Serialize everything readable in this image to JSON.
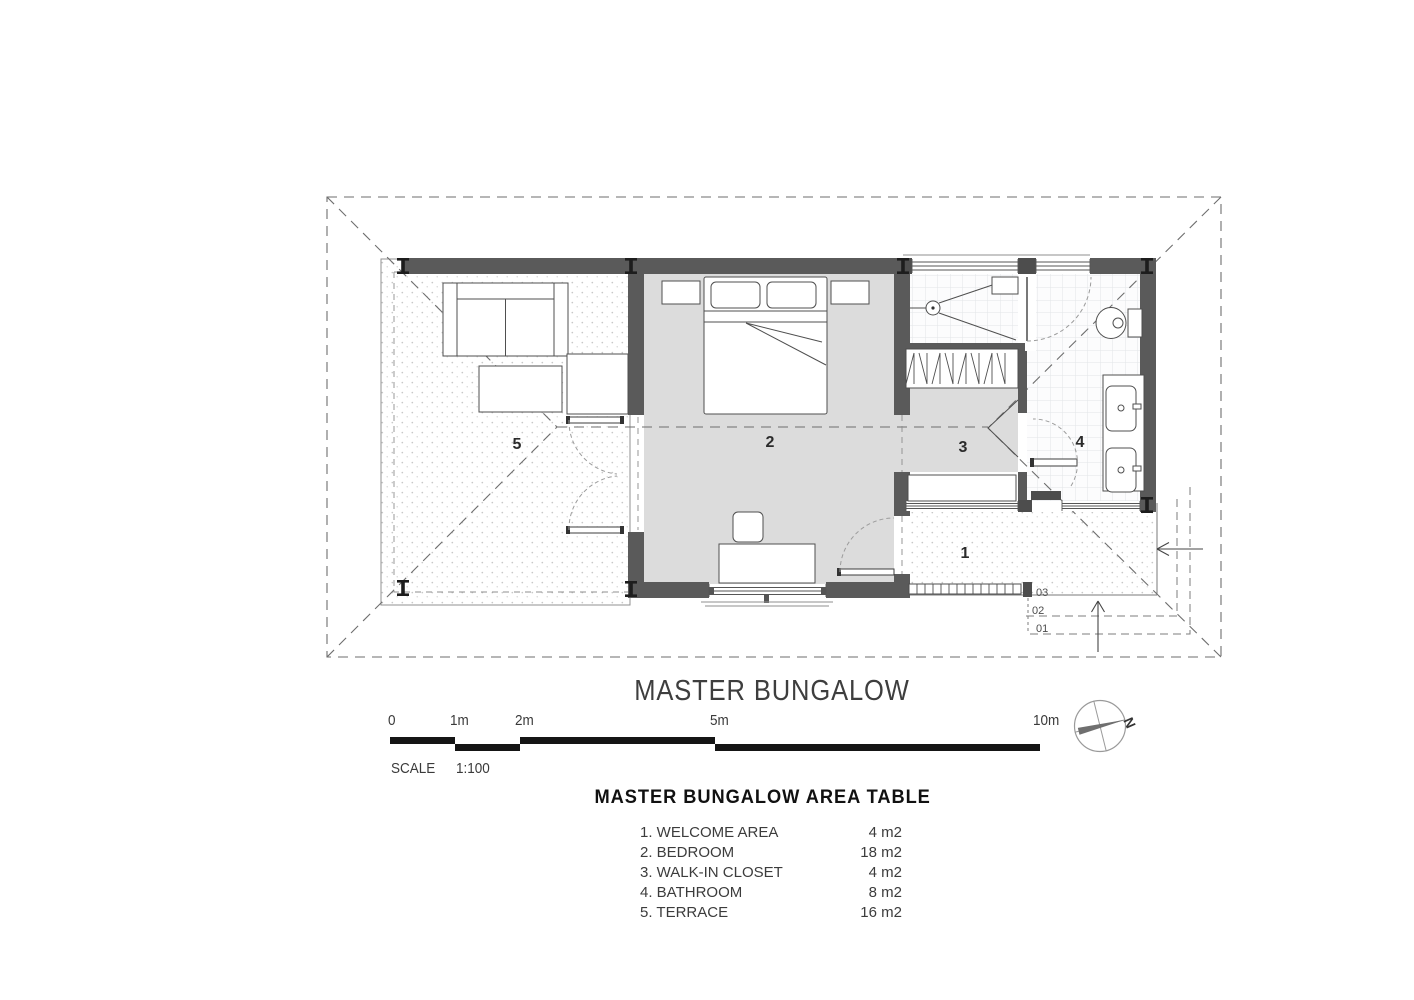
{
  "title": "MASTER BUNGALOW",
  "scalebar": {
    "ticks": [
      "0",
      "1m",
      "2m",
      "5m",
      "10m"
    ],
    "scale_label": "SCALE",
    "scale_value": "1:100"
  },
  "compass": {
    "north_label": "N"
  },
  "plan": {
    "room_labels": {
      "welcome": "1",
      "bedroom": "2",
      "closet": "3",
      "bathroom": "4",
      "terrace": "5"
    },
    "step_labels": [
      "03",
      "02",
      "01"
    ]
  },
  "area_table": {
    "title": "MASTER BUNGALOW AREA TABLE",
    "rows": [
      {
        "name": "1. WELCOME AREA",
        "area": "4 m2"
      },
      {
        "name": "2. BEDROOM",
        "area": "18 m2"
      },
      {
        "name": "3. WALK-IN CLOSET",
        "area": "4 m2"
      },
      {
        "name": "4. BATHROOM",
        "area": "8 m2"
      },
      {
        "name": "5. TERRACE",
        "area": "16 m2"
      }
    ]
  },
  "colors": {
    "wall": "#5a5a5a",
    "room_fill": "#dcdcdc",
    "line": "#4f4f4f",
    "dash": "#6e6e6e"
  }
}
